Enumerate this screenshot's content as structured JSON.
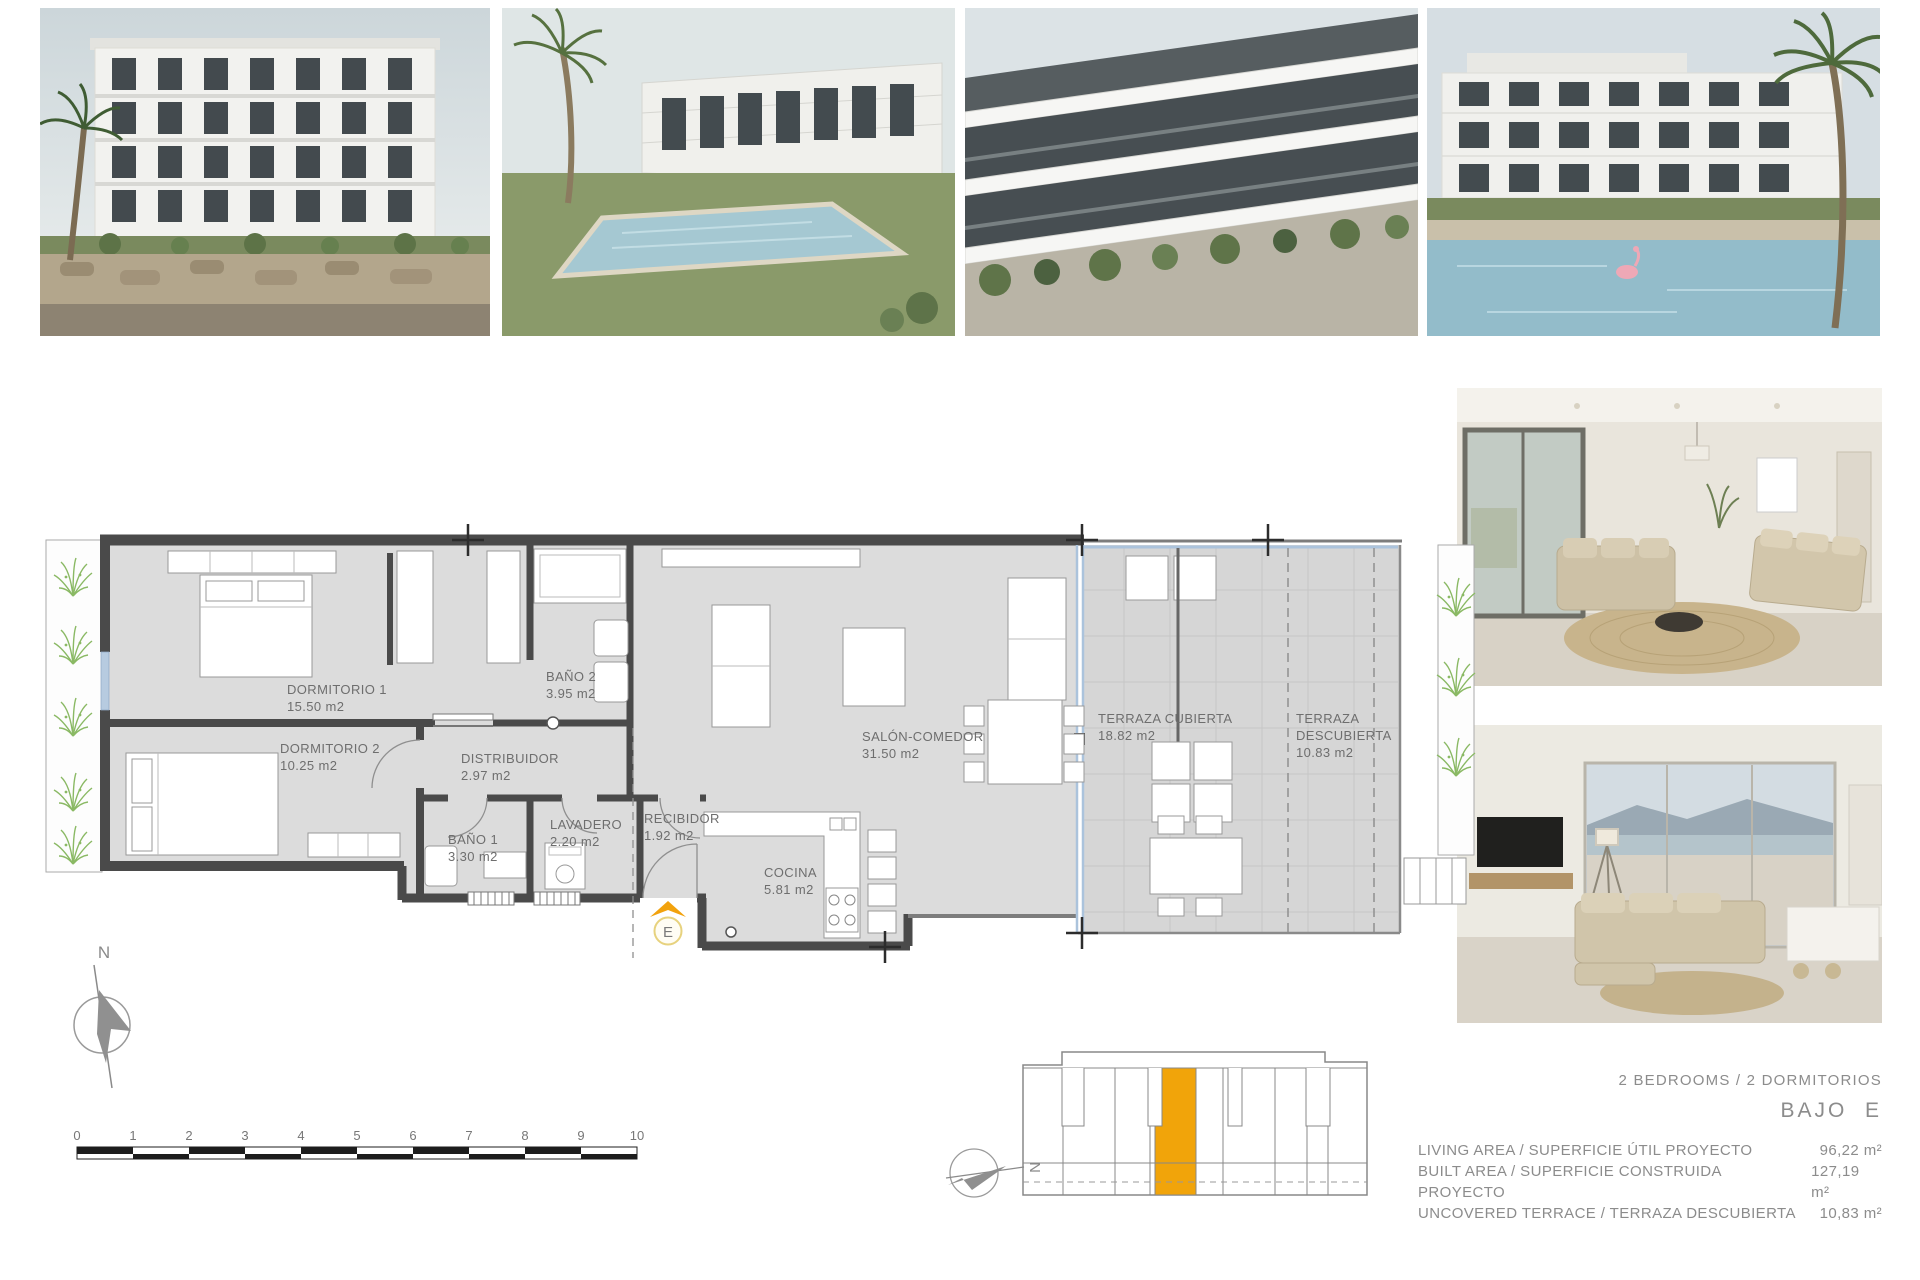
{
  "floor_plan": {
    "rooms": [
      {
        "name": "DORMITORIO 1",
        "area": "15.50 m2"
      },
      {
        "name": "DORMITORIO 2",
        "area": "10.25 m2"
      },
      {
        "name": "BAÑO 2",
        "area": "3.95 m2"
      },
      {
        "name": "DISTRIBUIDOR",
        "area": "2.97 m2"
      },
      {
        "name": "BAÑO 1",
        "area": "3.30 m2"
      },
      {
        "name": "LAVADERO",
        "area": "2.20 m2"
      },
      {
        "name": "RECIBIDOR",
        "area": "1.92 m2"
      },
      {
        "name": "COCINA",
        "area": "5.81 m2"
      },
      {
        "name": "SALÓN-COMEDOR",
        "area": "31.50 m2"
      },
      {
        "name": "TERRAZA CUBIERTA",
        "area": "18.82 m2"
      },
      {
        "name": "TERRAZA",
        "name2": "DESCUBIERTA",
        "area": "10.83 m2"
      }
    ],
    "entrance_label": "E",
    "compass_label": "N"
  },
  "scale_bar": {
    "ticks": [
      "0",
      "1",
      "2",
      "3",
      "4",
      "5",
      "6",
      "7",
      "8",
      "9",
      "10"
    ]
  },
  "key_plan": {
    "compass_label": "N"
  },
  "summary": {
    "bedrooms_line": "2 BEDROOMS / 2 DORMITORIOS",
    "unit_label": "BAJO  E",
    "rows": [
      {
        "label": "LIVING AREA / SUPERFICIE ÚTIL PROYECTO",
        "value": "96,22 m²"
      },
      {
        "label": "BUILT AREA / SUPERFICIE CONSTRUIDA PROYECTO",
        "value": "127,19 m²"
      },
      {
        "label": "UNCOVERED TERRACE / TERRAZA DESCUBIERTA",
        "value": "10,83 m²"
      }
    ]
  },
  "colors": {
    "accent_orange": "#F2A20D",
    "wall_gray": "#4A4A4A",
    "floor_gray": "#DCDCDC",
    "glass_blue": "#ABC3DC",
    "plant_green": "#8AB964",
    "label_text": "#6E6E6E",
    "summary_text": "#8C8C8C"
  }
}
